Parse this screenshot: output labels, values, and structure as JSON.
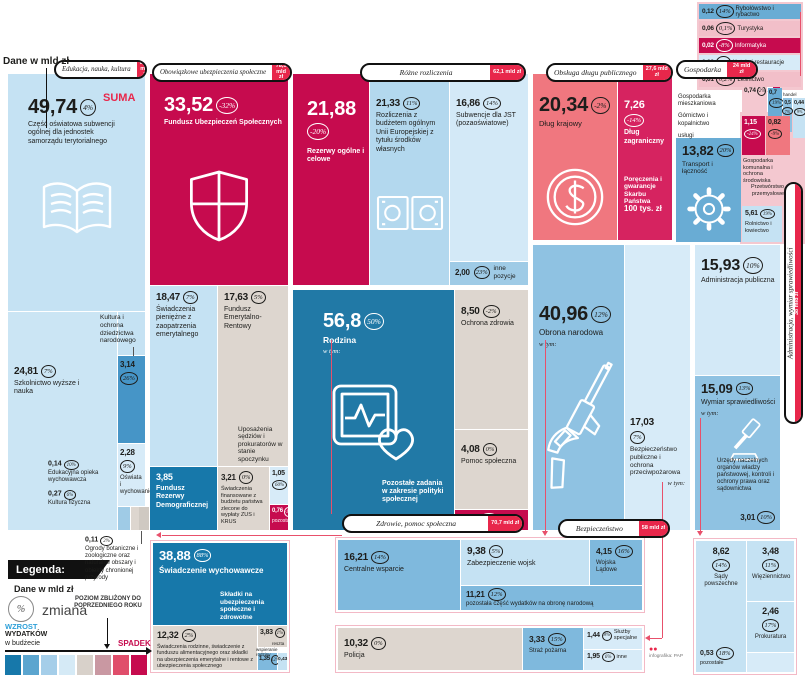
{
  "misc": {
    "units": "Dane w mld zł",
    "suma": "SUMA",
    "wtym": "w tym:"
  },
  "badges": {
    "edukacja": {
      "label": "Edukacja, nauka, kultura",
      "total": "80,5 mld zł"
    },
    "ubezpieczenia": {
      "label": "Obowiązkowe ubezpieczenia społeczne",
      "total": "78,5 mld zł"
    },
    "rozliczenia": {
      "label": "Różne rozliczenia",
      "total": "62,1 mld zł"
    },
    "dlug": {
      "label": "Obsługa długu publicznego",
      "total": "27,6 mld zł"
    },
    "gospodarka": {
      "label": "Gospodarka",
      "total": "24 mld zł"
    },
    "zdrowie": {
      "label": "Zdrowie, pomoc społeczna",
      "total": "70,7 mld zł"
    },
    "bezpieczenstwo": {
      "label": "Bezpieczeństwo",
      "total": "58 mld zł"
    },
    "administracja": {
      "label": "Administracja, wymiar sprawiedliwości",
      "total": "38 mld zł"
    }
  },
  "t": {
    "subwencja": {
      "v": "49,74",
      "p": "4%",
      "label": "Część oświatowa subwencji ogólnej dla jednostek samorządu terytorialnego"
    },
    "szkolnictwo": {
      "v": "24,81",
      "p": "7%",
      "label": "Szkolnictwo wyższe i nauka"
    },
    "kultura": {
      "v": "3,14",
      "p": "26%"
    },
    "kultura_l": {
      "label": "Kultura i ochrona dziedzictwa narodowego"
    },
    "oswiata": {
      "v": "2,28",
      "p": "9%",
      "label": "Oświata i wychowanie"
    },
    "opieka": {
      "v": "0,14",
      "p": "10%",
      "label": "Edukacyjna opieka wychowawcza"
    },
    "kfiz": {
      "v": "0,27",
      "p": "6%",
      "label": "Kultura fizyczna"
    },
    "ogrody": {
      "v": "0,11",
      "p": "2%",
      "label": "Ogrody botaniczne i zoologiczne oraz naturalne obszary i obiekty chronionej przyrody"
    },
    "fus": {
      "v": "33,52",
      "p": "-32%",
      "label": "Fundusz Ubezpieczeń Społecznych"
    },
    "emeryt": {
      "v": "18,47",
      "p": "7%",
      "label": "Świadczenia pieniężne z zaopatrzenia emerytalnego"
    },
    "fer": {
      "v": "17,63",
      "p": "5%",
      "label": "Fundusz Emerytalno-Rentowy",
      "note": "Uposażenia sędziów i prokuratorów w stanie spoczynku"
    },
    "frd": {
      "v": "3,85",
      "label": "Fundusz Rezerwy Demograficznej"
    },
    "zuskrus": {
      "v": "3,21",
      "p": "0%",
      "label": "Świadczenia finansowane z budżetu państwa zlecone do wypłaty ZUS i KRUS"
    },
    "b105": {
      "v": "1,05",
      "p": "60%"
    },
    "b076": {
      "v": "0,76",
      "p": "-1%",
      "label": "pozostałe"
    },
    "rezerwy": {
      "v": "21,88",
      "p": "-20%",
      "label": "Rezerwy ogólne i celowe"
    },
    "ue": {
      "v": "21,33",
      "p": "11%",
      "label": "Rozliczenia z budżetem ogólnym Unii Europejskiej z tytułu środków własnych"
    },
    "jst": {
      "v": "16,86",
      "p": "14%",
      "label": "Subwencje dla JST (pozaoświatowe)"
    },
    "innepoz": {
      "v": "2,00",
      "p": "23%",
      "label": "inne pozycje"
    },
    "rodzina": {
      "v": "56,8",
      "p": "50%",
      "label": "Rodzina",
      "note": "Pozostałe zadania w zakresie polityki społecznej"
    },
    "ozdrowia": {
      "v": "8,50",
      "p": "-2%",
      "label": "Ochrona zdrowia"
    },
    "pomoc": {
      "v": "4,08",
      "p": "0%",
      "label": "Pomoc społeczna"
    },
    "b128": {
      "v": "1,28",
      "p": "-74%"
    },
    "wych": {
      "v": "38,88",
      "p": "88%",
      "label": "Świadczenie wychowawcze",
      "note": "Składki na ubezpieczenia społeczne i zdrowotne"
    },
    "rodzinne": {
      "v": "12,32",
      "p": "2%",
      "label": "Świadczenia rodzinne, świadczenie z funduszu alimentacyjnego oraz składki na ubezpieczenia emerytalne i rentowe z ubezpieczenia społecznego"
    },
    "b383": {
      "v": "3,83",
      "p": "1%"
    },
    "wspieranie": {
      "label": "wspieranie rodziny"
    },
    "b135": {
      "v": "1,35",
      "p": "12%"
    },
    "reszta": {
      "v": "0,43",
      "label": "reszta"
    },
    "krajowy": {
      "v": "20,34",
      "p": "-2%",
      "label": "Dług krajowy"
    },
    "zagr": {
      "v": "7,26",
      "p": "-14%",
      "label": "Dług zagraniczny",
      "note": "Poręczenia i gwarancje Skarbu Państwa",
      "note2": "100 tys. zł"
    },
    "obrona": {
      "v": "40,96",
      "p": "12%",
      "label": "Obrona narodowa"
    },
    "bezppubl": {
      "v": "17,03",
      "p": "7%",
      "label": "Bezpieczeństwo publiczne i ochrona przeciwpożarowa"
    },
    "centralne": {
      "v": "16,21",
      "p": "14%",
      "label": "Centralne wsparcie"
    },
    "zabezp": {
      "v": "9,38",
      "p": "5%",
      "label": "Zabezpieczenie wojsk"
    },
    "ladowe": {
      "v": "4,15",
      "p": "16%",
      "label": "Wojska Lądowe"
    },
    "pozobrona": {
      "v": "11,21",
      "p": "12%",
      "label": "pozostała część wydatków na obronę narodową"
    },
    "policja": {
      "v": "10,32",
      "p": "0%",
      "label": "Policja"
    },
    "straz": {
      "v": "3,33",
      "p": "15%",
      "label": "Straż pożarna"
    },
    "sluzby": {
      "v": "1,44",
      "p": "8%",
      "label": "Służby specjalne"
    },
    "inne": {
      "v": "1,95",
      "p": "6%",
      "label": "inne"
    },
    "admpub": {
      "v": "15,93",
      "p": "10%",
      "label": "Administracja publiczna"
    },
    "wymiar": {
      "v": "15,09",
      "p": "13%",
      "label": "Wymiar sprawiedliwości",
      "note": "Urzędy naczelnych organów władzy państwowej, kontroli i ochrony prawa oraz sądownictwa"
    },
    "urzedy": {
      "v": "3,01",
      "p": "10%"
    },
    "sady": {
      "v": "8,62",
      "p": "14%",
      "label": "Sądy powszechne"
    },
    "wiez": {
      "v": "3,48",
      "p": "11%",
      "label": "Więziennictwo"
    },
    "prok": {
      "v": "2,46",
      "p": "17%",
      "label": "Prokuratura"
    },
    "b053": {
      "v": "0,53",
      "p": "18%",
      "label": "pozostałe"
    },
    "transport": {
      "v": "13,82",
      "p": "20%",
      "label": "Transport i łączność"
    },
    "rolnictwo": {
      "v": "5,61",
      "p": "19%",
      "label": "Rolnictwo i łowiectwo"
    },
    "komunalna": {
      "v": "1,15",
      "p": "-24%",
      "label": "Gospodarka komunalna i ochrona środowiska"
    },
    "przetw": {
      "v": "0,82",
      "p": "-9%",
      "label": "Przetwórstwo przemysłowe"
    },
    "mieszk": {
      "v": "0,74",
      "p": "-2%",
      "label": "Gospodarka mieszkaniowa"
    },
    "gornictwo": {
      "v": "0,7",
      "p": "19%",
      "label": "Górnictwo i kopalnictwo"
    },
    "uslugi": {
      "v": "0,5",
      "p": "7%",
      "label": "usługi"
    },
    "handel": {
      "v": "0,44",
      "p": "9%",
      "label": "handel"
    },
    "ryby": {
      "v": "0,12",
      "p": "14%",
      "label": "Rybołówstwo i rybactwo"
    },
    "turystyka": {
      "v": "0,06",
      "p": "0,1%",
      "label": "Turystyka"
    },
    "informatyka": {
      "v": "0,02",
      "p": "-8%",
      "label": "Informatyka"
    },
    "hotele": {
      "v": "0,02",
      "p": "9%",
      "label": "Hotele i restauracje"
    },
    "lesnictwo": {
      "v": "0,01",
      "p": "0,2%",
      "label": "Leśnictwo"
    }
  },
  "legend": {
    "title": "Legenda:",
    "units": "Dane w mld zł",
    "pct": "%",
    "zmiana": "zmiana",
    "w1": "WZROST",
    "w2": "WYDATKÓW",
    "w3": "w budżecie",
    "poziom": "POZIOM ZBLIŻONY DO POPRZEDNIEGO ROKU",
    "spadek": "SPADEK"
  },
  "credit": "infografika: PAP",
  "chart_data": {
    "type": "table",
    "title": "Dane w mld zł",
    "groups": [
      {
        "name": "Edukacja, nauka, kultura",
        "total": "80,5 mld zł",
        "items": [
          [
            "Część oświatowa subwencji ogólnej dla jednostek samorządu terytorialnego",
            "49,74",
            "4%"
          ],
          [
            "Szkolnictwo wyższe i nauka",
            "24,81",
            "7%"
          ],
          [
            "Kultura i ochrona dziedzictwa narodowego",
            "3,14",
            "26%"
          ],
          [
            "Oświata i wychowanie",
            "2,28",
            "9%"
          ],
          [
            "Kultura fizyczna",
            "0,27",
            "6%"
          ],
          [
            "Edukacyjna opieka wychowawcza",
            "0,14",
            "10%"
          ],
          [
            "Ogrody botaniczne i zoologiczne oraz naturalne obszary i obiekty chronionej przyrody",
            "0,11",
            "2%"
          ]
        ]
      },
      {
        "name": "Obowiązkowe ubezpieczenia społeczne",
        "total": "78,5 mld zł",
        "items": [
          [
            "Fundusz Ubezpieczeń Społecznych",
            "33,52",
            "-32%"
          ],
          [
            "Świadczenia pieniężne z zaopatrzenia emerytalnego",
            "18,47",
            "7%"
          ],
          [
            "Fundusz Emerytalno-Rentowy",
            "17,63",
            "5%"
          ],
          [
            "Fundusz Rezerwy Demograficznej",
            "3,85",
            ""
          ],
          [
            "Świadczenia finansowane z budżetu państwa zlecone do wypłaty ZUS i KRUS",
            "3,21",
            "0%"
          ],
          [
            "",
            "1,05",
            "60%"
          ],
          [
            "pozostałe",
            "0,76",
            "-1%"
          ]
        ]
      },
      {
        "name": "Różne rozliczenia",
        "total": "62,1 mld zł",
        "items": [
          [
            "Rezerwy ogólne i celowe",
            "21,88",
            "-20%"
          ],
          [
            "Rozliczenia z budżetem ogólnym Unii Europejskiej z tytułu środków własnych",
            "21,33",
            "11%"
          ],
          [
            "Subwencje dla JST (pozaoświatowe)",
            "16,86",
            "14%"
          ],
          [
            "inne pozycje",
            "2,00",
            "23%"
          ]
        ]
      },
      {
        "name": "Obsługa długu publicznego",
        "total": "27,6 mld zł",
        "items": [
          [
            "Dług krajowy",
            "20,34",
            "-2%"
          ],
          [
            "Dług zagraniczny",
            "7,26",
            "-14%"
          ],
          [
            "Poręczenia i gwarancje Skarbu Państwa",
            "100 tys. zł",
            ""
          ]
        ]
      },
      {
        "name": "Gospodarka",
        "total": "24 mld zł",
        "items": [
          [
            "Transport i łączność",
            "13,82",
            "20%"
          ],
          [
            "Rolnictwo i łowiectwo",
            "5,61",
            "19%"
          ],
          [
            "Gospodarka komunalna i ochrona środowiska",
            "1,15",
            "-24%"
          ],
          [
            "Przetwórstwo przemysłowe",
            "0,82",
            "-9%"
          ],
          [
            "Gospodarka mieszkaniowa",
            "0,74",
            "-2%"
          ],
          [
            "Górnictwo i kopalnictwo",
            "0,7",
            "19%"
          ],
          [
            "usługi",
            "0,5",
            "7%"
          ],
          [
            "handel",
            "0,44",
            "9%"
          ],
          [
            "Rybołówstwo i rybactwo",
            "0,12",
            "14%"
          ],
          [
            "Turystyka",
            "0,06",
            "0,1%"
          ],
          [
            "Informatyka",
            "0,02",
            "-8%"
          ],
          [
            "Hotele i restauracje",
            "0,02",
            "9%"
          ],
          [
            "Leśnictwo",
            "0,01",
            "0,2%"
          ]
        ]
      },
      {
        "name": "Zdrowie, pomoc społeczna",
        "total": "70,7 mld zł",
        "items": [
          [
            "Rodzina",
            "56,8",
            "50%"
          ],
          [
            "Świadczenie wychowawcze",
            "38,88",
            "88%"
          ],
          [
            "Świadczenia rodzinne, świadczenie z funduszu alimentacyjnego oraz składki na ubezpieczenia emerytalne i rentowe z ubezpieczenia społecznego",
            "12,32",
            "2%"
          ],
          [
            "Ochrona zdrowia",
            "8,50",
            "-2%"
          ],
          [
            "Pomoc społeczna",
            "4,08",
            "0%"
          ],
          [
            "Składki na ubezpieczenia społeczne i zdrowotne",
            "3,83",
            "1%"
          ],
          [
            "wspieranie rodziny",
            "1,35",
            "12%"
          ],
          [
            "Pozostałe zadania w zakresie polityki społecznej",
            "1,28",
            "-74%"
          ],
          [
            "reszta",
            "0,43",
            ""
          ]
        ]
      },
      {
        "name": "Bezpieczeństwo",
        "total": "58 mld zł",
        "items": [
          [
            "Obrona narodowa",
            "40,96",
            "12%"
          ],
          [
            "Bezpieczeństwo publiczne i ochrona przeciwpożarowa",
            "17,03",
            "7%"
          ],
          [
            "Centralne wsparcie",
            "16,21",
            "14%"
          ],
          [
            "pozostała część wydatków na obronę narodową",
            "11,21",
            "12%"
          ],
          [
            "Policja",
            "10,32",
            "0%"
          ],
          [
            "Zabezpieczenie wojsk",
            "9,38",
            "5%"
          ],
          [
            "Wojska Lądowe",
            "4,15",
            "16%"
          ],
          [
            "Straż pożarna",
            "3,33",
            "15%"
          ],
          [
            "inne",
            "1,95",
            "6%"
          ],
          [
            "Służby specjalne",
            "1,44",
            "8%"
          ]
        ]
      },
      {
        "name": "Administracja, wymiar sprawiedliwości",
        "total": "38 mld zł",
        "items": [
          [
            "Administracja publiczna",
            "15,93",
            "10%"
          ],
          [
            "Wymiar sprawiedliwości",
            "15,09",
            "13%"
          ],
          [
            "Sądy powszechne",
            "8,62",
            "14%"
          ],
          [
            "Więziennictwo",
            "3,48",
            "11%"
          ],
          [
            "Urzędy naczelnych organów władzy państwowej, kontroli i ochrony prawa oraz sądownictwa",
            "3,01",
            "10%"
          ],
          [
            "Prokuratura",
            "2,46",
            "17%"
          ],
          [
            "pozostałe",
            "0,53",
            "18%"
          ]
        ]
      }
    ]
  }
}
